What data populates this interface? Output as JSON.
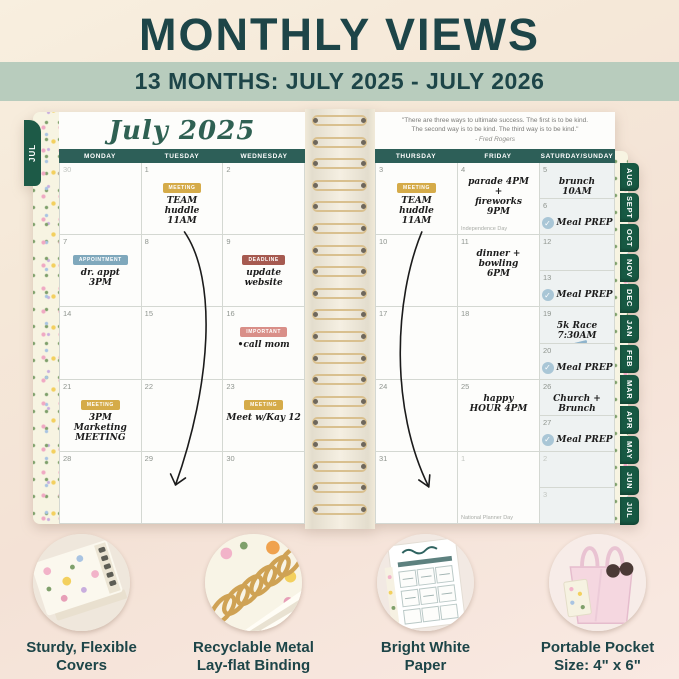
{
  "header": {
    "title": "MONTHLY VIEWS",
    "subtitle": "13 MONTHS: JULY 2025 - JULY 2026"
  },
  "quote": {
    "line1": "\"There are three ways to ultimate success. The first is to be kind.",
    "line2": "The second way is to be kind. The third way is to be kind.\"",
    "attribution": "- Fred Rogers"
  },
  "left_page": {
    "edge_tab": "JUL",
    "month_title": "July 2025",
    "day_headers": [
      "MONDAY",
      "TUESDAY",
      "WEDNESDAY"
    ],
    "cells": [
      {
        "date": "30",
        "muted": true
      },
      {
        "date": "1",
        "badge": {
          "label": "MEETING",
          "color": "gold"
        },
        "note": "TEAM\nhuddle\n11AM"
      },
      {
        "date": "2"
      },
      {
        "date": "7",
        "badge": {
          "label": "APPOINTMENT",
          "color": "blue"
        },
        "note": "dr. appt\n3PM"
      },
      {
        "date": "8"
      },
      {
        "date": "9",
        "badge": {
          "label": "DEADLINE",
          "color": "red"
        },
        "note": "update\nwebsite"
      },
      {
        "date": "14"
      },
      {
        "date": "15"
      },
      {
        "date": "16",
        "badge": {
          "label": "IMPORTANT",
          "color": "pink"
        },
        "note": "•call mom"
      },
      {
        "date": "21",
        "badge": {
          "label": "MEETING",
          "color": "gold"
        },
        "note": "3PM\nMarketing\nMEETING"
      },
      {
        "date": "22"
      },
      {
        "date": "23",
        "badge": {
          "label": "MEETING",
          "color": "gold"
        },
        "note": "Meet w/Kay 12"
      },
      {
        "date": "28"
      },
      {
        "date": "29"
      },
      {
        "date": "30"
      }
    ]
  },
  "right_page": {
    "day_headers": [
      "THURSDAY",
      "FRIDAY",
      "SATURDAY/SUNDAY"
    ],
    "weeks": [
      {
        "thursday": {
          "date": "3",
          "badge": {
            "label": "MEETING",
            "color": "gold"
          },
          "note": "TEAM\nhuddle\n11AM"
        },
        "friday": {
          "date": "4",
          "note": "parade 4PM\n+\nfireworks\n9PM",
          "holiday": "Independence Day"
        },
        "saturday": {
          "date": "5",
          "note": "brunch\n10AM"
        },
        "sunday": {
          "date": "6",
          "check": true,
          "note": "Meal PREP"
        }
      },
      {
        "thursday": {
          "date": "10"
        },
        "friday": {
          "date": "11",
          "note": "dinner +\nbowling\n6PM"
        },
        "saturday": {
          "date": "12"
        },
        "sunday": {
          "date": "13",
          "check": true,
          "note": "Meal PREP"
        }
      },
      {
        "thursday": {
          "date": "17"
        },
        "friday": {
          "date": "18"
        },
        "saturday": {
          "date": "19",
          "note": "5k Race\n7:30AM",
          "icon": "sneaker-icon"
        },
        "sunday": {
          "date": "20",
          "check": true,
          "note": "Meal PREP"
        }
      },
      {
        "thursday": {
          "date": "24"
        },
        "friday": {
          "date": "25",
          "note": "happy\nHOUR 4PM"
        },
        "saturday": {
          "date": "26",
          "note": "Church +\nBrunch"
        },
        "sunday": {
          "date": "27",
          "check": true,
          "note": "Meal PREP"
        }
      },
      {
        "thursday": {
          "date": "31"
        },
        "friday": {
          "date": "1",
          "muted": true,
          "holiday": "National Planner Day"
        },
        "saturday": {
          "date": "2",
          "muted": true
        },
        "sunday": {
          "date": "3",
          "muted": true
        }
      }
    ]
  },
  "month_tabs": [
    "AUG",
    "SEPT",
    "OCT",
    "NOV",
    "DEC",
    "JAN",
    "FEB",
    "MAR",
    "APR",
    "MAY",
    "JUN",
    "JUL"
  ],
  "features": [
    {
      "label": "Sturdy, Flexible\nCovers",
      "icon": "floral-cover-photo"
    },
    {
      "label": "Recyclable Metal\nLay-flat Binding",
      "icon": "spiral-binding-photo"
    },
    {
      "label": "Bright White\nPaper",
      "icon": "white-paper-photo"
    },
    {
      "label": "Portable Pocket\nSize: 4\" x 6\"",
      "icon": "tote-bag-photo"
    }
  ],
  "colors": {
    "accent_teal": "#1d4548",
    "banner_sage": "#b8ccbd",
    "day_header_bar": "#2d5f58",
    "tab_green": "#175943",
    "badge_gold": "#d5ab49",
    "badge_blue": "#7fa8bc",
    "badge_red": "#a65a50",
    "badge_pink": "#d98f88",
    "check_blue": "#a9c6d6",
    "spiral_gold": "#d9c08f"
  }
}
